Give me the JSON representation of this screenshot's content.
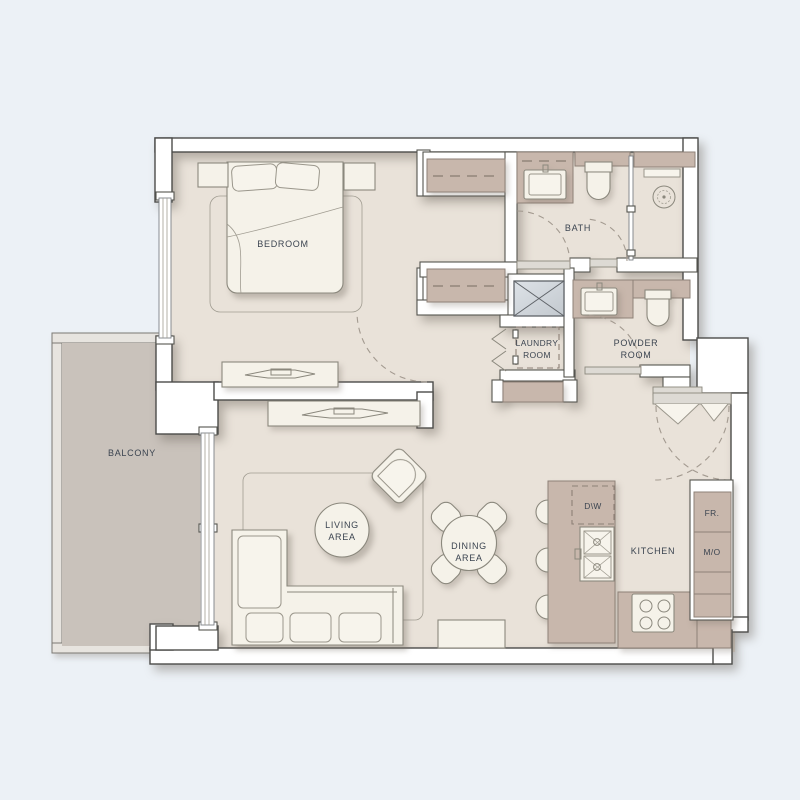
{
  "title": "apartment-floor-plan",
  "labels": {
    "bedroom": "BEDROOM",
    "bath": "BATH",
    "balcony": "BALCONY",
    "kitchen": "KITCHEN",
    "dishwasher": "D\\W",
    "fridge": "FR.",
    "micro_oven": "M/O",
    "laundry_line1": "LAUNDRY",
    "laundry_line2": "ROOM",
    "powder_line1": "POWDER",
    "powder_line2": "ROOM",
    "living_line1": "LIVING",
    "living_line2": "AREA",
    "dining_line1": "DINING",
    "dining_line2": "AREA"
  },
  "colors": {
    "background": "#ecf1f6",
    "interior_floor": "#e9e2d9",
    "balcony_floor": "#c9c2bb",
    "wall_fill": "#ffffff",
    "wall_outline": "#4c4c4a",
    "cabinet_tan": "#c8b7ac",
    "furniture_cream": "#f5f2e9",
    "shaft_fill": "#d6dbe0",
    "label_text": "#3b4450"
  },
  "rooms": [
    {
      "id": "bedroom",
      "label": "BEDROOM"
    },
    {
      "id": "bath",
      "label": "BATH"
    },
    {
      "id": "powder-room",
      "label": "POWDER ROOM"
    },
    {
      "id": "laundry-room",
      "label": "LAUNDRY ROOM"
    },
    {
      "id": "balcony",
      "label": "BALCONY"
    },
    {
      "id": "living-area",
      "label": "LIVING AREA"
    },
    {
      "id": "dining-area",
      "label": "DINING AREA"
    },
    {
      "id": "kitchen",
      "label": "KITCHEN"
    }
  ],
  "appliances": [
    {
      "id": "dishwasher",
      "label": "D\\W"
    },
    {
      "id": "fridge",
      "label": "FR."
    },
    {
      "id": "microwave-oven",
      "label": "M/O"
    }
  ]
}
